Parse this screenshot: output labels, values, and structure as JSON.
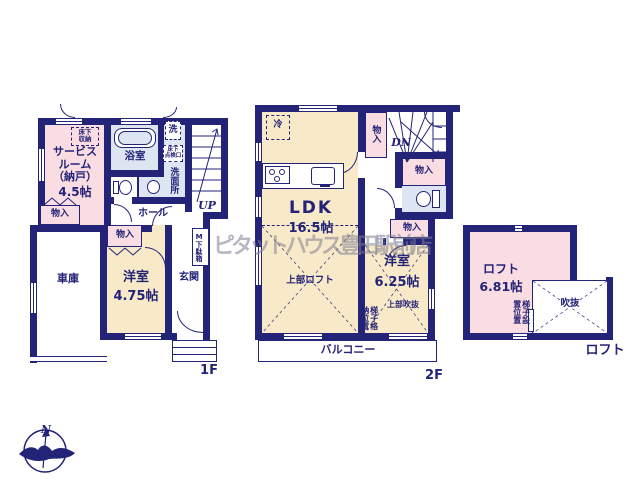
{
  "watermark": "ピタットハウス豊田駅前店",
  "compass": {
    "north": "N"
  },
  "floor1": {
    "label": "1F",
    "service_room_name": "サービス\nルーム\n（納戸）",
    "service_room_size": "4.5帖",
    "underfloor_storage": "床下\n収納",
    "bathroom": "浴室",
    "washer": "洗",
    "underfloor_hatch": "床下\n点検口",
    "washroom": "洗面所",
    "hall": "ホール",
    "stairs_up": "UP",
    "closet_a": "物入",
    "closet_b": "物入",
    "garage": "車庫",
    "western_room_name": "洋室",
    "western_room_size": "4.75帖",
    "entrance": "玄関",
    "shoe_cabinet": "M下駄箱"
  },
  "floor2": {
    "label": "2F",
    "ldk_name": "LDK",
    "ldk_size": "16.5帖",
    "refrigerator": "冷",
    "stairs_down": "DN",
    "closet_top": "物入",
    "closet_mid": "物入",
    "closet_bottom": "物入",
    "western_room_name": "洋室",
    "western_room_size": "6.25帖",
    "upper_loft": "上部ロフト",
    "open_ceiling": "上部吹抜",
    "ladder_storage": "梯子格納位置",
    "balcony": "バルコニー"
  },
  "loft": {
    "label": "ロフト",
    "room_name": "ロフト",
    "room_size": "6.81帖",
    "void": "吹抜",
    "ladder_position": "梯子設置位置"
  },
  "colors": {
    "wall": "#232377",
    "room_pink": "#fadde2",
    "room_cream": "#f8e9c8",
    "room_blue": "#dde4f2"
  }
}
